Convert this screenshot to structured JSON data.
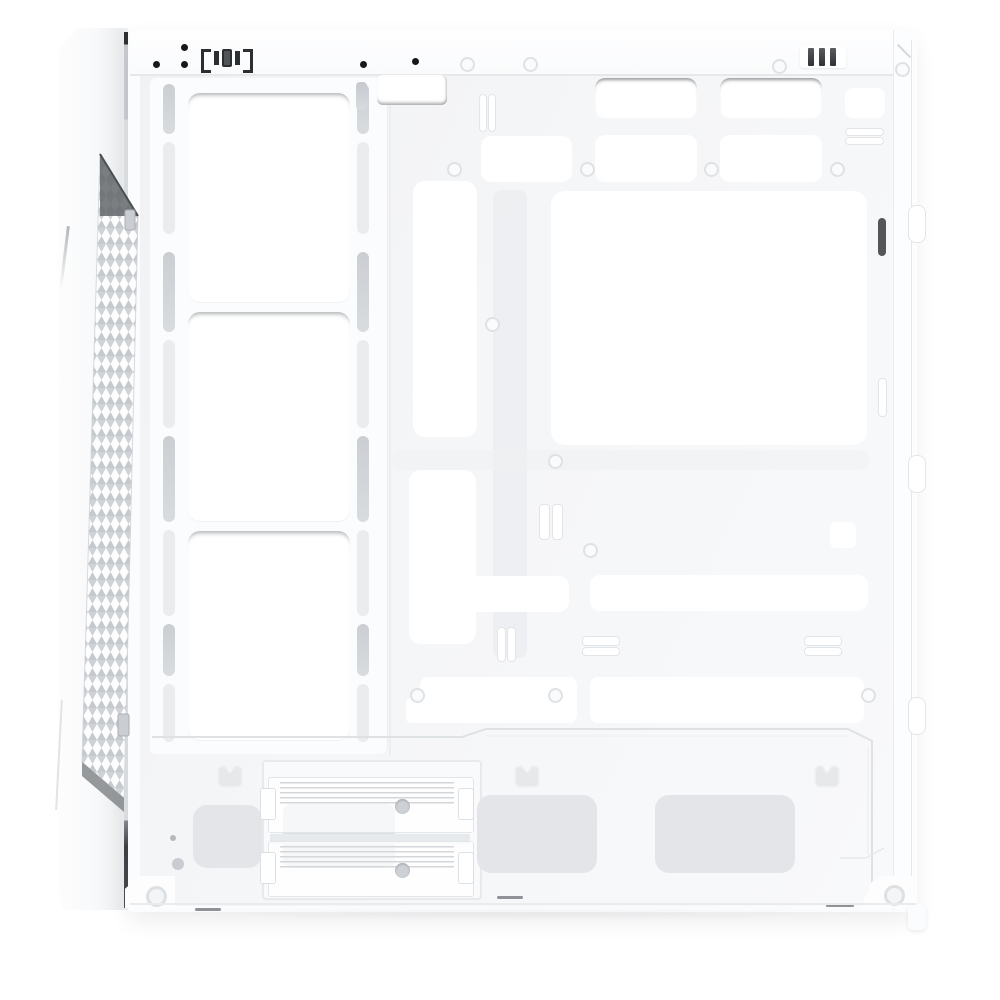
{
  "meta": {
    "subject": "white mid-tower PC case, side view with panel removed, empty interior"
  },
  "palette": {
    "bg": "#ffffff",
    "body": "#fbfcfd",
    "panel": "#f4f5f7",
    "cutout": "#ffffff",
    "line": "#e4e7e9",
    "slot_gray": "#cfd3d6",
    "dark": "#3a3d40",
    "mesh_stroke": "#c6cace",
    "mesh_shadow": "#63676b",
    "pad": "#e3e5e8",
    "recess": "#dcdfe2"
  },
  "fan_wall": {
    "openings": [
      {
        "x": 188,
        "y": 93,
        "w": 162,
        "h": 210
      },
      {
        "x": 188,
        "y": 312,
        "w": 162,
        "h": 210
      },
      {
        "x": 188,
        "y": 531,
        "w": 162,
        "h": 210
      }
    ],
    "rails": [
      163,
      357
    ],
    "rail_slots": [
      {
        "y": 84,
        "h": 50,
        "tone": "gray"
      },
      {
        "y": 142,
        "h": 92,
        "tone": "light"
      },
      {
        "y": 252,
        "h": 80,
        "tone": "gray"
      },
      {
        "y": 340,
        "h": 88,
        "tone": "light"
      },
      {
        "y": 436,
        "h": 86,
        "tone": "gray"
      },
      {
        "y": 530,
        "h": 86,
        "tone": "light"
      },
      {
        "y": 624,
        "h": 52,
        "tone": "gray"
      },
      {
        "y": 684,
        "h": 58,
        "tone": "light"
      }
    ]
  },
  "tray": {
    "cutouts": [
      {
        "x": 377,
        "y": 75,
        "w": 70,
        "h": 30,
        "r": 6,
        "edge": "bottom"
      },
      {
        "x": 595,
        "y": 78,
        "w": 102,
        "h": 40,
        "r": 10,
        "edge": "top"
      },
      {
        "x": 720,
        "y": 78,
        "w": 102,
        "h": 40,
        "r": 10,
        "edge": "top"
      },
      {
        "x": 845,
        "y": 88,
        "w": 40,
        "h": 30,
        "r": 8,
        "edge": ""
      },
      {
        "x": 481,
        "y": 136,
        "w": 91,
        "h": 46,
        "r": 10,
        "edge": ""
      },
      {
        "x": 595,
        "y": 135,
        "w": 102,
        "h": 47,
        "r": 10,
        "edge": ""
      },
      {
        "x": 720,
        "y": 135,
        "w": 102,
        "h": 47,
        "r": 10,
        "edge": ""
      },
      {
        "x": 413,
        "y": 181,
        "w": 64,
        "h": 256,
        "r": 12,
        "edge": ""
      },
      {
        "x": 551,
        "y": 191,
        "w": 316,
        "h": 254,
        "r": 14,
        "edge": ""
      },
      {
        "x": 409,
        "y": 470,
        "w": 67,
        "h": 174,
        "r": 12,
        "edge": ""
      },
      {
        "x": 468,
        "y": 576,
        "w": 101,
        "h": 36,
        "r": 10,
        "edge": ""
      },
      {
        "x": 590,
        "y": 575,
        "w": 278,
        "h": 36,
        "r": 10,
        "edge": ""
      },
      {
        "x": 830,
        "y": 522,
        "w": 26,
        "h": 26,
        "r": 6,
        "edge": ""
      },
      {
        "x": 420,
        "y": 677,
        "w": 157,
        "h": 46,
        "r": 8,
        "edge": ""
      },
      {
        "x": 406,
        "y": 698,
        "w": 28,
        "h": 25,
        "r": 5,
        "edge": ""
      },
      {
        "x": 590,
        "y": 677,
        "w": 274,
        "h": 46,
        "r": 8,
        "edge": ""
      }
    ],
    "thin_slots": [
      {
        "x": 356,
        "y": 82,
        "w": 11,
        "h": 28,
        "tone": "gray"
      },
      {
        "x": 479,
        "y": 94,
        "w": 6,
        "h": 36,
        "tone": "light"
      },
      {
        "x": 488,
        "y": 94,
        "w": 6,
        "h": 36,
        "tone": "light"
      },
      {
        "x": 845,
        "y": 128,
        "w": 37,
        "h": 6,
        "tone": "light"
      },
      {
        "x": 845,
        "y": 137,
        "w": 37,
        "h": 6,
        "tone": "light"
      },
      {
        "x": 539,
        "y": 504,
        "w": 9,
        "h": 34,
        "tone": "light"
      },
      {
        "x": 552,
        "y": 504,
        "w": 9,
        "h": 34,
        "tone": "light"
      },
      {
        "x": 497,
        "y": 627,
        "w": 7,
        "h": 33,
        "tone": "light"
      },
      {
        "x": 507,
        "y": 627,
        "w": 7,
        "h": 33,
        "tone": "light"
      },
      {
        "x": 582,
        "y": 636,
        "w": 36,
        "h": 8,
        "tone": "light"
      },
      {
        "x": 582,
        "y": 647,
        "w": 36,
        "h": 7,
        "tone": "light"
      },
      {
        "x": 804,
        "y": 636,
        "w": 36,
        "h": 8,
        "tone": "light"
      },
      {
        "x": 804,
        "y": 647,
        "w": 36,
        "h": 7,
        "tone": "light"
      },
      {
        "x": 878,
        "y": 218,
        "w": 8,
        "h": 38,
        "tone": "dark"
      },
      {
        "x": 878,
        "y": 378,
        "w": 7,
        "h": 37,
        "tone": "light"
      }
    ],
    "screw_dots": [
      [
        153,
        61
      ],
      [
        181,
        44
      ],
      [
        181,
        61
      ],
      [
        360,
        61
      ],
      [
        412,
        58
      ]
    ],
    "screw_rings": [
      [
        460,
        57
      ],
      [
        523,
        57
      ],
      [
        772,
        59
      ],
      [
        895,
        62
      ],
      [
        447,
        162
      ],
      [
        580,
        162
      ],
      [
        704,
        162
      ],
      [
        830,
        162
      ],
      [
        485,
        317
      ],
      [
        548,
        454
      ],
      [
        583,
        543
      ],
      [
        410,
        688
      ],
      [
        548,
        688
      ],
      [
        861,
        688
      ]
    ]
  },
  "bottom": {
    "crowns": [
      215,
      512,
      812
    ],
    "pads": [
      {
        "x": 193,
        "y": 805,
        "w": 69,
        "h": 63
      },
      {
        "x": 477,
        "y": 795,
        "w": 120,
        "h": 78
      },
      {
        "x": 655,
        "y": 795,
        "w": 140,
        "h": 78
      }
    ],
    "drive_trays": [
      {
        "y": 777
      },
      {
        "y": 841
      }
    ],
    "dashes": [
      {
        "x": 195,
        "y": 908,
        "w": 26
      },
      {
        "x": 497,
        "y": 896,
        "w": 26
      },
      {
        "x": 826,
        "y": 904,
        "w": 28
      }
    ],
    "dots": [
      {
        "x": 170,
        "y": 835,
        "size": "s"
      },
      {
        "x": 172,
        "y": 858,
        "size": "l"
      }
    ]
  },
  "rear": {
    "tabs": [
      205,
      455,
      697
    ]
  }
}
